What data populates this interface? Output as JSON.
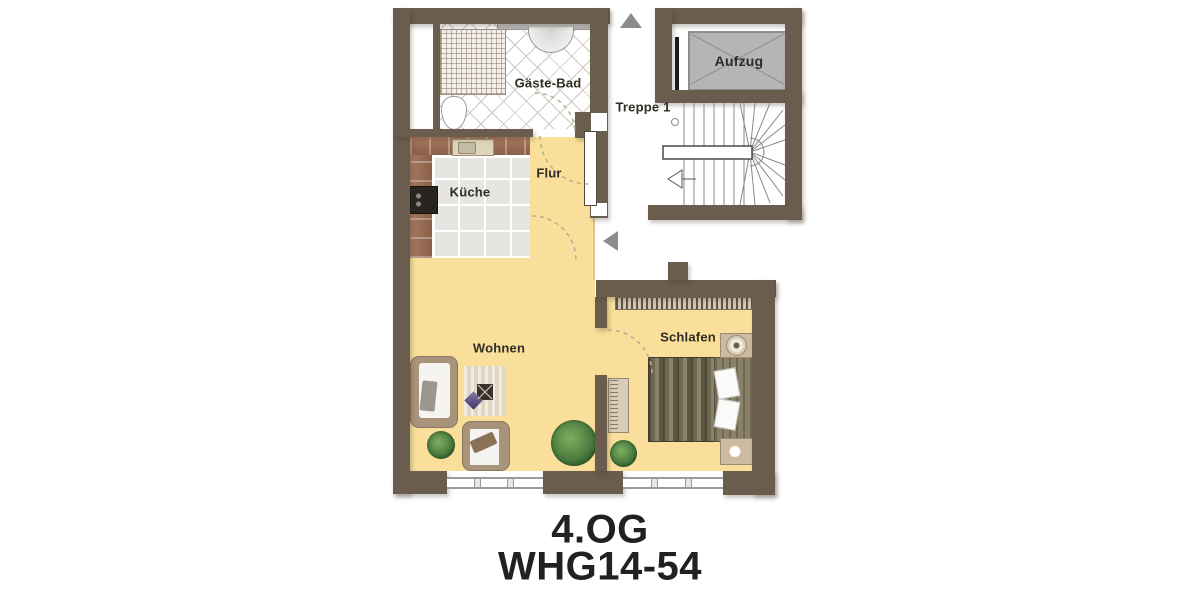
{
  "floorplan": {
    "labels": {
      "guest_bath": "Gäste-Bad",
      "stairs": "Treppe 1",
      "elevator": "Aufzug",
      "kitchen": "Küche",
      "hallway": "Flur",
      "living": "Wohnen",
      "bedroom": "Schlafen"
    },
    "title": {
      "floor": "4.OG",
      "unit": "WHG14-54"
    },
    "colors": {
      "wall": "#6b5d4d",
      "floor_yellow": "#fadf9a",
      "elevator_gray": "#b5b5b5",
      "arrow_gray": "#8d8d8d",
      "plant_green": "#3f6f35",
      "label_text": "#2e2c27"
    },
    "icons": {
      "north_arrow": "up-triangle",
      "entry_arrow": "left-triangle",
      "stair_direction": "left-arrow"
    }
  }
}
